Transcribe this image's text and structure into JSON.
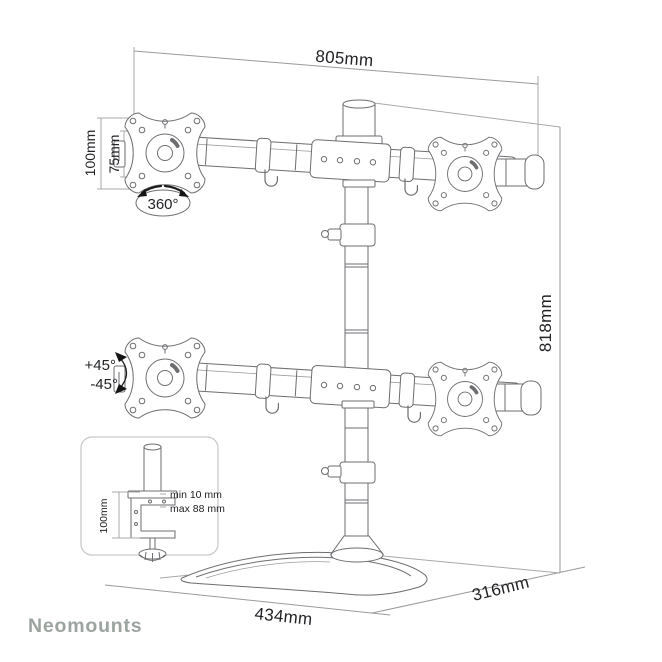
{
  "brand": {
    "name": "Neomounts",
    "color": "#9CA49F"
  },
  "drawing": "quad-monitor-desk-stand-dimension-diagram",
  "dimensions": {
    "arm_width": "805mm",
    "column_height": "818mm",
    "vesa_outer": "100mm",
    "vesa_inner": "75mm",
    "rotation": "360°",
    "tilt_plus": "+45°",
    "tilt_minus": "-45°",
    "base_width": "434mm",
    "base_depth": "316mm"
  },
  "clamp_inset": {
    "height": "100mm",
    "min_thickness": "min 10 mm",
    "max_thickness": "max 88 mm"
  },
  "colors": {
    "background": "#ffffff",
    "product_line": "#6e6e72",
    "dimension_line": "#a8a8aa",
    "label_text": "#222326",
    "inset_border": "#c9c9cb",
    "brand": "#9CA49F"
  }
}
